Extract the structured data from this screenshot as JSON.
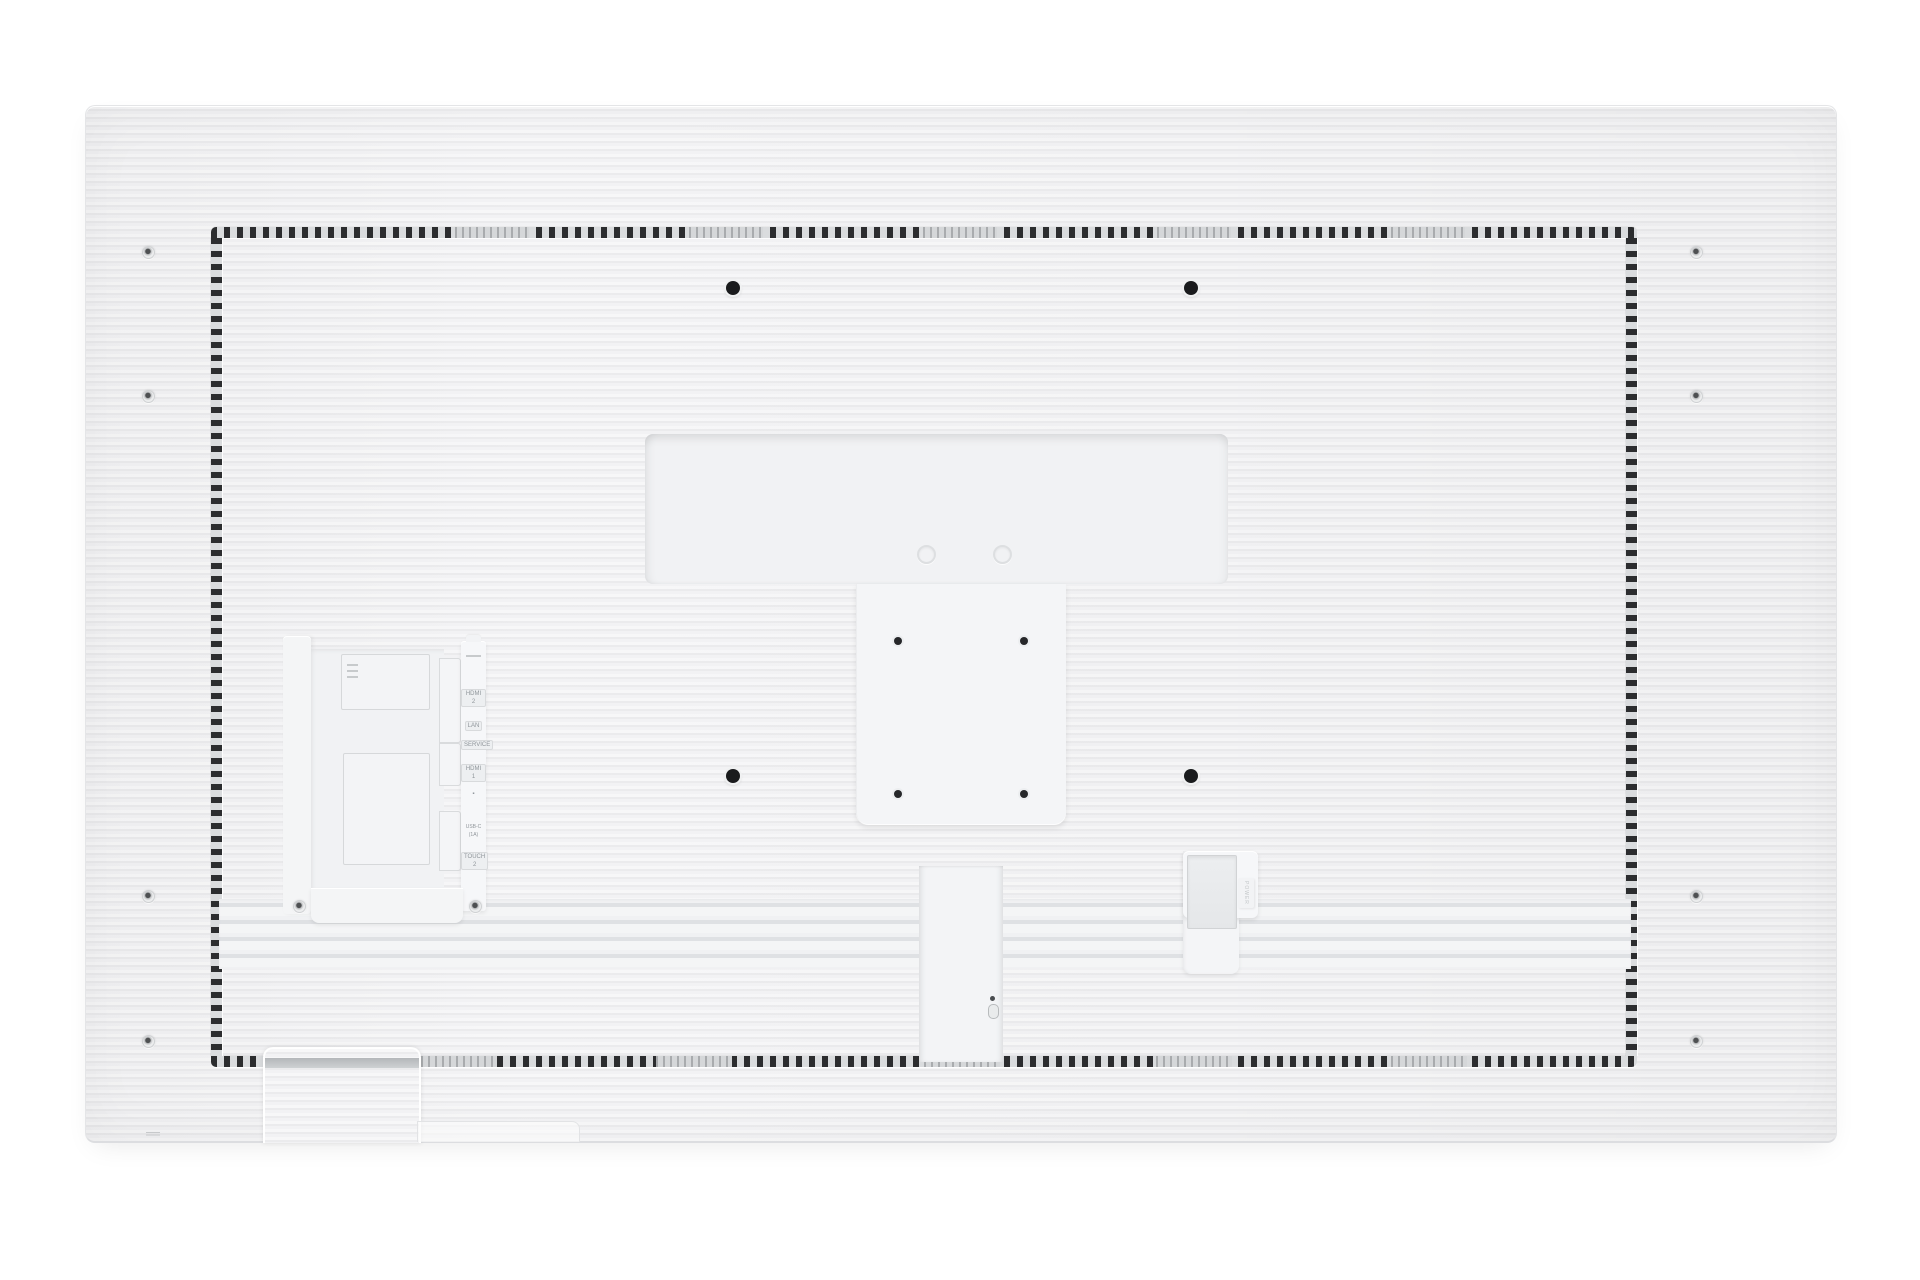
{
  "meta": {
    "description": "Product photo: rear view of a white flat-panel display with horizontal ridged back cover, perforated vent border, central VESA mount recess, left connector bay and bottom cable vents",
    "background_color": "#ffffff",
    "panel_color": "#f1f1f3",
    "vent_dash_color": "#2c2d2f"
  },
  "ports": {
    "labels": [
      {
        "id": "hdmi-2",
        "label": "HDMI 2"
      },
      {
        "id": "lan",
        "label": "LAN"
      },
      {
        "id": "service",
        "label": "SERVICE"
      },
      {
        "id": "hdmi-1",
        "label": "HDMI 1"
      },
      {
        "id": "audio",
        "label": "▪"
      },
      {
        "id": "usb-c",
        "label": "USB-C (1A)"
      },
      {
        "id": "touch-2",
        "label": "TOUCH 2"
      }
    ]
  },
  "power": {
    "label": "POWER"
  }
}
